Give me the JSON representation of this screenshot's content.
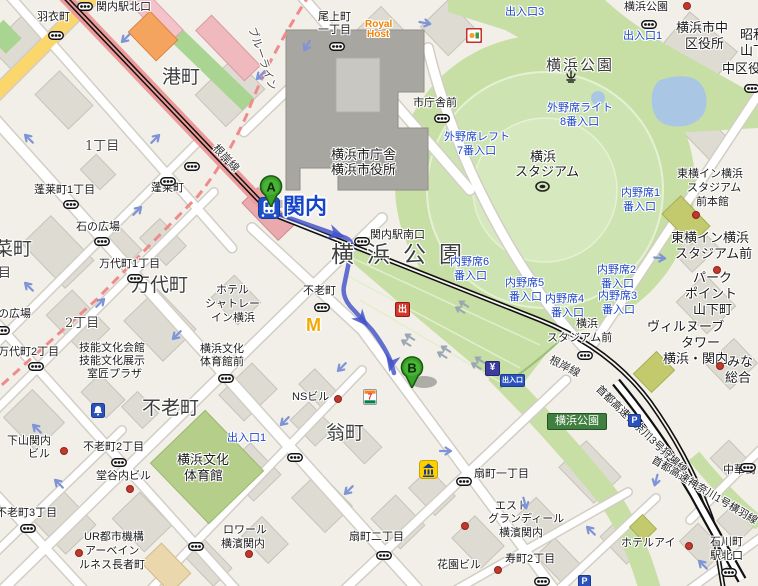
{
  "title": "関内駅周辺地図（横浜公園・横浜スタジアム）",
  "station": {
    "name": "関内",
    "line": "根岸線"
  },
  "markers": [
    {
      "letter": "A",
      "x": 271,
      "y": 207
    },
    {
      "letter": "B",
      "x": 412,
      "y": 388
    }
  ],
  "route": {
    "from": "A",
    "to": "B",
    "color": "#4353c9",
    "path": "M272,212 L346,238 Q354,242 351,252 L344,286 Q342,296 350,306 L372,330 Q385,347 391,362 L394,373",
    "arrows": [
      [
        342,
        236,
        19
      ],
      [
        366,
        324,
        48
      ],
      [
        390,
        369,
        103
      ]
    ]
  },
  "badges": {
    "exit_red": "出",
    "yen": "¥",
    "parking": "P",
    "entrance": "出入口",
    "park_exit": "横浜公園"
  },
  "brands": {
    "royal_host_1": "Royal",
    "royal_host_2": "Host",
    "mcdonalds": "M",
    "seven": "7"
  },
  "colors": {
    "park_green": "#c7dfa5",
    "route_blue": "#4353c9",
    "rail_red": "#ec9a9a",
    "road_yellow": "#fbd66b",
    "marker_green": "#37a327",
    "station_blue": "#1c50c8"
  },
  "labels": [
    {
      "t": "関内駅北口",
      "x": 96,
      "y": 2,
      "c": "p"
    },
    {
      "t": "羽衣町",
      "x": 37,
      "y": 12,
      "c": "p"
    },
    {
      "t": "尾上町",
      "x": 318,
      "y": 12,
      "c": "p"
    },
    {
      "t": "一丁目",
      "x": 318,
      "y": 25,
      "c": "p"
    },
    {
      "t": "Royal",
      "x": 365,
      "y": 20,
      "c": "o"
    },
    {
      "t": "Host",
      "x": 367,
      "y": 30,
      "c": "o"
    },
    {
      "t": "港町",
      "x": 162,
      "y": 68,
      "c": "lg"
    },
    {
      "t": "1丁目",
      "x": 85,
      "y": 140,
      "c": "ch"
    },
    {
      "t": "蓬莱町1丁目",
      "x": 34,
      "y": 185,
      "c": "p"
    },
    {
      "t": "蓬莱町",
      "x": 151,
      "y": 183,
      "c": "p"
    },
    {
      "t": "石の広場",
      "x": 76,
      "y": 222,
      "c": "p"
    },
    {
      "t": "万代町1丁目",
      "x": 99,
      "y": 259,
      "c": "p"
    },
    {
      "t": "万代町",
      "x": 131,
      "y": 276,
      "c": "lg"
    },
    {
      "t": "菜町",
      "x": -6,
      "y": 240,
      "c": "lg"
    },
    {
      "t": "目",
      "x": -2,
      "y": 267,
      "c": "ch"
    },
    {
      "t": "2丁目",
      "x": 65,
      "y": 317,
      "c": "ch"
    },
    {
      "t": "の広場",
      "x": -2,
      "y": 309,
      "c": "p"
    },
    {
      "t": "万代町2丁目",
      "x": -2,
      "y": 347,
      "c": "p"
    },
    {
      "t": "技能文化会館",
      "x": 79,
      "y": 343,
      "c": "p"
    },
    {
      "t": "技能文化展示",
      "x": 79,
      "y": 356,
      "c": "p"
    },
    {
      "t": "室匠プラザ",
      "x": 87,
      "y": 369,
      "c": "p"
    },
    {
      "t": "下山関内",
      "x": 7,
      "y": 436,
      "c": "p"
    },
    {
      "t": "ビル",
      "x": 28,
      "y": 449,
      "c": "p"
    },
    {
      "t": "不老町2丁目",
      "x": 83,
      "y": 442,
      "c": "p"
    },
    {
      "t": "不老町3丁目",
      "x": -4,
      "y": 508,
      "c": "p"
    },
    {
      "t": "堂谷内ビル",
      "x": 96,
      "y": 471,
      "c": "p"
    },
    {
      "t": "UR都市機構",
      "x": 84,
      "y": 532,
      "c": "p"
    },
    {
      "t": "アーベイン",
      "x": 85,
      "y": 546,
      "c": "p"
    },
    {
      "t": "ルネス長者町",
      "x": 79,
      "y": 560,
      "c": "p"
    },
    {
      "t": "不老町",
      "x": 142,
      "y": 399,
      "c": "lg"
    },
    {
      "t": "横浜文化",
      "x": 177,
      "y": 453,
      "c": "pm"
    },
    {
      "t": "体育館",
      "x": 184,
      "y": 469,
      "c": "pm"
    },
    {
      "t": "出入口1",
      "x": 227,
      "y": 433,
      "c": "b"
    },
    {
      "t": "ホテル",
      "x": 216,
      "y": 285,
      "c": "p"
    },
    {
      "t": "シャトレー",
      "x": 205,
      "y": 299,
      "c": "p"
    },
    {
      "t": "イン横浜",
      "x": 211,
      "y": 313,
      "c": "p"
    },
    {
      "t": "横浜文化",
      "x": 200,
      "y": 344,
      "c": "p"
    },
    {
      "t": "体育館前",
      "x": 200,
      "y": 357,
      "c": "p"
    },
    {
      "t": "不老町",
      "x": 303,
      "y": 286,
      "c": "p"
    },
    {
      "t": "横浜市庁舎",
      "x": 331,
      "y": 148,
      "c": "pm"
    },
    {
      "t": "横浜市役所",
      "x": 331,
      "y": 163,
      "c": "pm"
    },
    {
      "t": "関内駅南口",
      "x": 370,
      "y": 230,
      "c": "p"
    },
    {
      "t": "横浜公園",
      "x": 331,
      "y": 244,
      "c": "xl"
    },
    {
      "t": "翁町",
      "x": 326,
      "y": 424,
      "c": "lg"
    },
    {
      "t": "NSビル",
      "x": 292,
      "y": 392,
      "c": "p"
    },
    {
      "t": "扇町二丁目",
      "x": 349,
      "y": 532,
      "c": "p"
    },
    {
      "t": "扇町一丁目",
      "x": 474,
      "y": 469,
      "c": "p"
    },
    {
      "t": "花園ビル",
      "x": 437,
      "y": 560,
      "c": "p"
    },
    {
      "t": "エスト",
      "x": 495,
      "y": 501,
      "c": "p"
    },
    {
      "t": "グランディール",
      "x": 488,
      "y": 514,
      "c": "p"
    },
    {
      "t": "横濱関内",
      "x": 499,
      "y": 528,
      "c": "p"
    },
    {
      "t": "ロワール",
      "x": 223,
      "y": 525,
      "c": "p"
    },
    {
      "t": "横濱関内",
      "x": 221,
      "y": 539,
      "c": "p"
    },
    {
      "t": "寿町2丁目",
      "x": 505,
      "y": 554,
      "c": "p"
    },
    {
      "t": "石川町",
      "x": 710,
      "y": 537,
      "c": "p"
    },
    {
      "t": "駅北口",
      "x": 710,
      "y": 551,
      "c": "p"
    },
    {
      "t": "ホテルアイ",
      "x": 621,
      "y": 538,
      "c": "p"
    },
    {
      "t": "中華街",
      "x": 723,
      "y": 465,
      "c": "p"
    },
    {
      "t": "市庁舎前",
      "x": 413,
      "y": 98,
      "c": "p"
    },
    {
      "t": "横浜公園",
      "x": 624,
      "y": 2,
      "c": "p"
    },
    {
      "t": "横浜市中",
      "x": 676,
      "y": 21,
      "c": "pm"
    },
    {
      "t": "区役所",
      "x": 685,
      "y": 37,
      "c": "pm"
    },
    {
      "t": "昭和",
      "x": 740,
      "y": 28,
      "c": "pm"
    },
    {
      "t": "山下",
      "x": 740,
      "y": 44,
      "c": "pm"
    },
    {
      "t": "中区役",
      "x": 722,
      "y": 62,
      "c": "pm"
    },
    {
      "t": "出入口3",
      "x": 505,
      "y": 7,
      "c": "b"
    },
    {
      "t": "出入口1",
      "x": 623,
      "y": 31,
      "c": "b"
    },
    {
      "t": "横浜公園",
      "x": 546,
      "y": 58,
      "c": "md"
    },
    {
      "t": "外野席ライト",
      "x": 547,
      "y": 103,
      "c": "b"
    },
    {
      "t": "8番入口",
      "x": 560,
      "y": 117,
      "c": "b"
    },
    {
      "t": "外野席レフト",
      "x": 444,
      "y": 132,
      "c": "b"
    },
    {
      "t": "7番入口",
      "x": 457,
      "y": 146,
      "c": "b"
    },
    {
      "t": "横浜",
      "x": 530,
      "y": 150,
      "c": "pm"
    },
    {
      "t": "スタジアム",
      "x": 515,
      "y": 165,
      "c": "pm"
    },
    {
      "t": "内野席6",
      "x": 450,
      "y": 257,
      "c": "b"
    },
    {
      "t": "番入口",
      "x": 454,
      "y": 271,
      "c": "b"
    },
    {
      "t": "内野席5",
      "x": 505,
      "y": 278,
      "c": "b"
    },
    {
      "t": "番入口",
      "x": 509,
      "y": 292,
      "c": "b"
    },
    {
      "t": "内野席4",
      "x": 545,
      "y": 294,
      "c": "b"
    },
    {
      "t": "番入口",
      "x": 551,
      "y": 308,
      "c": "b"
    },
    {
      "t": "内野席2",
      "x": 597,
      "y": 265,
      "c": "b"
    },
    {
      "t": "番入口",
      "x": 601,
      "y": 279,
      "c": "b"
    },
    {
      "t": "内野席3",
      "x": 598,
      "y": 291,
      "c": "b"
    },
    {
      "t": "番入口",
      "x": 602,
      "y": 305,
      "c": "b"
    },
    {
      "t": "内野席1",
      "x": 621,
      "y": 188,
      "c": "b"
    },
    {
      "t": "番入口",
      "x": 623,
      "y": 202,
      "c": "b"
    },
    {
      "t": "横浜",
      "x": 576,
      "y": 319,
      "c": "p"
    },
    {
      "t": "スタジアム前",
      "x": 547,
      "y": 333,
      "c": "p"
    },
    {
      "t": "東横イン横浜",
      "x": 677,
      "y": 169,
      "c": "p"
    },
    {
      "t": "スタジアム",
      "x": 687,
      "y": 183,
      "c": "p"
    },
    {
      "t": "前本館",
      "x": 696,
      "y": 197,
      "c": "p"
    },
    {
      "t": "東横イン横浜",
      "x": 671,
      "y": 231,
      "c": "pm"
    },
    {
      "t": "スタジアム前",
      "x": 675,
      "y": 247,
      "c": "pm"
    },
    {
      "t": "パーク",
      "x": 693,
      "y": 271,
      "c": "pm"
    },
    {
      "t": "ポイント",
      "x": 685,
      "y": 287,
      "c": "pm"
    },
    {
      "t": "山下町",
      "x": 693,
      "y": 303,
      "c": "pm"
    },
    {
      "t": "ヴィルヌーブ",
      "x": 647,
      "y": 320,
      "c": "pm"
    },
    {
      "t": "タワー",
      "x": 681,
      "y": 336,
      "c": "pm"
    },
    {
      "t": "横浜・関内",
      "x": 663,
      "y": 352,
      "c": "pm"
    },
    {
      "t": "みな",
      "x": 727,
      "y": 355,
      "c": "pm"
    },
    {
      "t": "総合",
      "x": 725,
      "y": 371,
      "c": "pm"
    },
    {
      "t": "根岸線",
      "x": 218,
      "y": 143,
      "c": "rl",
      "r": 47
    },
    {
      "t": "根岸線",
      "x": 552,
      "y": 355,
      "c": "rl",
      "r": 27
    },
    {
      "t": "首都高速神奈川3号狩場線",
      "x": 601,
      "y": 384,
      "c": "hw",
      "r": 44
    },
    {
      "t": "首都高速神奈川1号横羽線",
      "x": 655,
      "y": 455,
      "c": "hw",
      "r": 31
    },
    {
      "t": "ブルーライン",
      "x": 256,
      "y": 26,
      "c": "bl",
      "r": 71
    }
  ],
  "traffic_lights": [
    [
      85,
      2
    ],
    [
      56,
      31
    ],
    [
      337,
      42
    ],
    [
      442,
      114
    ],
    [
      192,
      162
    ],
    [
      168,
      177
    ],
    [
      71,
      200
    ],
    [
      102,
      237
    ],
    [
      135,
      274
    ],
    [
      36,
      362
    ],
    [
      322,
      303
    ],
    [
      362,
      237
    ],
    [
      226,
      374
    ],
    [
      119,
      458
    ],
    [
      28,
      524
    ],
    [
      295,
      453
    ],
    [
      384,
      551
    ],
    [
      464,
      477
    ],
    [
      542,
      577
    ],
    [
      196,
      542
    ],
    [
      649,
      20
    ],
    [
      752,
      84
    ],
    [
      585,
      351
    ],
    [
      729,
      568
    ],
    [
      748,
      463
    ],
    [
      2,
      326
    ]
  ],
  "oneway_arrows": [
    [
      124,
      34,
      135
    ],
    [
      30,
      134,
      -135
    ],
    [
      157,
      137,
      -45
    ],
    [
      305,
      42,
      120
    ],
    [
      259,
      71,
      135
    ],
    [
      425,
      22,
      10
    ],
    [
      139,
      209,
      -45
    ],
    [
      175,
      331,
      135
    ],
    [
      102,
      301,
      -45
    ],
    [
      30,
      282,
      -135
    ],
    [
      340,
      363,
      135
    ],
    [
      283,
      417,
      135
    ],
    [
      347,
      486,
      135
    ],
    [
      446,
      450,
      0
    ],
    [
      523,
      501,
      75
    ],
    [
      654,
      477,
      105
    ],
    [
      704,
      560,
      -135
    ],
    [
      592,
      526,
      -135
    ],
    [
      38,
      424,
      -135
    ],
    [
      60,
      479,
      -135
    ],
    [
      660,
      257,
      5
    ]
  ],
  "lane_arrows": [
    [
      408,
      334
    ],
    [
      444,
      346
    ],
    [
      478,
      357
    ],
    [
      462,
      301
    ]
  ],
  "poi_dots": [
    [
      337,
      398
    ],
    [
      63,
      450
    ],
    [
      129,
      488
    ],
    [
      78,
      552
    ],
    [
      248,
      553
    ],
    [
      464,
      525
    ],
    [
      497,
      569
    ],
    [
      688,
      545
    ],
    [
      695,
      214
    ],
    [
      716,
      269
    ],
    [
      719,
      365
    ],
    [
      686,
      5
    ]
  ]
}
